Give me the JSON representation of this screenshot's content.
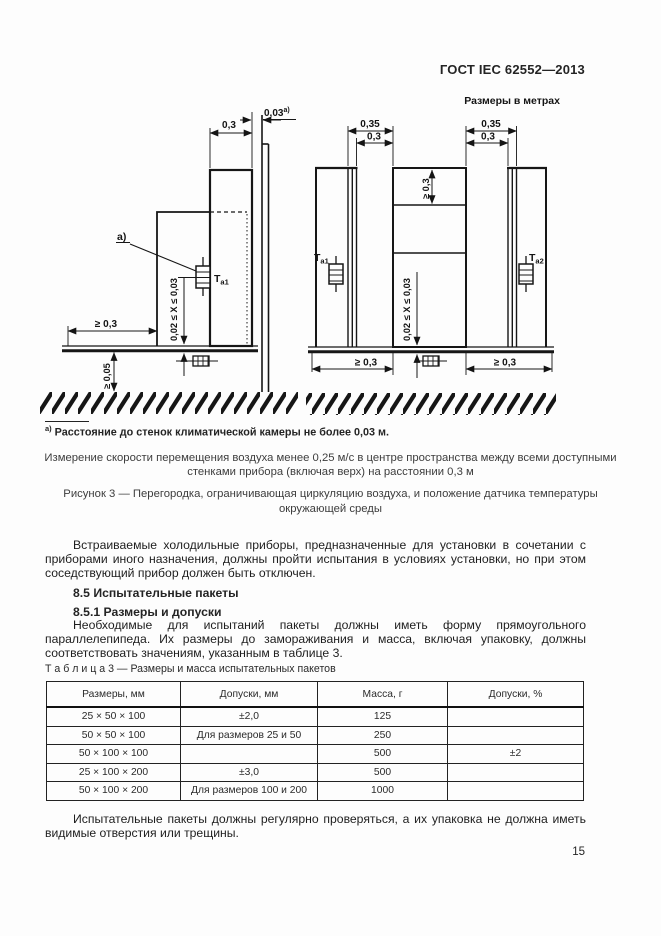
{
  "page": {
    "header": "ГОСТ IEC 62552—2013",
    "number": "15"
  },
  "figure": {
    "units_note": "Размеры в метрах",
    "dims": {
      "d03": "0,3",
      "d035": "0,35",
      "d003": "0,03",
      "sup": "а)",
      "ge03": "≥ 0,3",
      "ge005": "≥ 0,05",
      "xrange": "0,02 ≤ X ≤ 0,03"
    },
    "sensors": {
      "t_main": "Т",
      "t1_sub": "а1",
      "t2_sub": "а2"
    },
    "callout": "а)",
    "footnote": {
      "marker": "а)",
      "text": "Расстояние до стенок климатической камеры не более 0,03 м."
    },
    "note_line1": "Измерение скорости перемещения воздуха менее 0,25 м/с в центре пространства между всеми доступными",
    "note_line2": "стенками прибора (включая верх) на расстоянии 0,3 м",
    "caption_line1": "Рисунок 3 — Перегородка, ограничивающая циркуляцию воздуха, и положение датчика температуры",
    "caption_line2": "окружающей среды"
  },
  "body": {
    "para1": "Встраиваемые холодильные приборы, предназначенные для установки в сочетании с приборами иного назначения, должны пройти испытания в условиях установки, но при этом соседствующий прибор должен быть отключен.",
    "heading_85": "8.5 Испытательные пакеты",
    "heading_851": "8.5.1 Размеры и допуски",
    "para2": "Необходимые для испытаний пакеты должны иметь форму прямоугольного параллелепипеда. Их размеры до замораживания и масса, включая упаковку, должны соответствовать значениям, указанным в таблице 3.",
    "para3": "Испытательные пакеты должны регулярно проверяться, а их упаковка не должна иметь видимые отверстия или трещины."
  },
  "table": {
    "label": "Т а б л и ц а  3 — Размеры и масса испытательных пакетов",
    "headers": [
      "Размеры, мм",
      "Допуски, мм",
      "Масса, г",
      "Допуски, %"
    ],
    "rows": [
      [
        "25 × 50 × 100",
        "±2,0",
        "125",
        ""
      ],
      [
        "50 × 50 × 100",
        "Для размеров 25 и 50",
        "250",
        ""
      ],
      [
        "50 × 100 × 100",
        "",
        "500",
        "±2"
      ],
      [
        "25 × 100 × 200",
        "±3,0",
        "500",
        ""
      ],
      [
        "50 × 100 × 200",
        "Для размеров 100 и 200",
        "1000",
        ""
      ]
    ]
  }
}
